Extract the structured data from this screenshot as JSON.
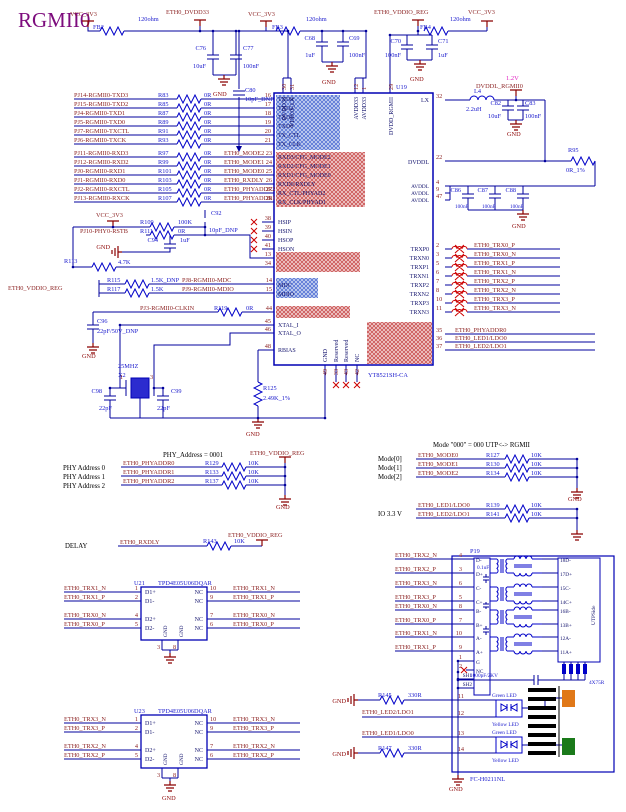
{
  "title": "RGMII0",
  "colors": {
    "wire": "#00009c",
    "part": "#1a1acd",
    "net": "#8a1f1f",
    "power": "#8b0000",
    "pink": "#e020c0",
    "purple": "#7d0c7d",
    "hatch_red": "#c03030",
    "hatch_blue": "#3355cc",
    "led_orange": "#e07818",
    "led_green": "#1a7a1a"
  },
  "top": {
    "vcc": "VCC_3V3",
    "fb2": "FB2",
    "fb3": "FB3",
    "fb4": "FB4",
    "ohm": "120ohm",
    "dvdd33": "ETH0_DVDD33",
    "vddio": "ETH0_VDDIO_REG",
    "gnd": "GND",
    "c76": "C76",
    "c76v": "10uF",
    "c77": "C77",
    "c77v": "100nF",
    "c80": "C80",
    "c80v": "10pF_DNP",
    "c68": "C68",
    "c68v": "1uF",
    "c69": "C69",
    "c69v": "100nF",
    "c70": "C70",
    "c70v": "100nF",
    "c71": "C71",
    "c71v": "1uF"
  },
  "chip": {
    "ref": "U19",
    "part": "YT8521SH-CA",
    "top_pins": [
      {
        "n": "30",
        "l": "DVDD33"
      },
      {
        "n": "31",
        "l": "VDD33_LX"
      },
      {
        "n": "12",
        "l": "AVDD33"
      },
      {
        "n": "1",
        "l": "AVDD33"
      },
      {
        "n": "29",
        "l": "DVDD_RGMII"
      }
    ],
    "lx": "LX",
    "n32": "32",
    "dvddl": "DVDDL",
    "n22": "22",
    "avddl": "AVDDL",
    "n4": "4",
    "n9": "9",
    "n47": "47",
    "gnd": "GND",
    "n49": "49",
    "res": "Reserved",
    "n33": "33",
    "n43": "43",
    "nc": "NC",
    "n42": "42"
  },
  "tx": [
    {
      "net": "PJ14-RGMII0-TXD3",
      "r": "R83",
      "v": "0R",
      "pin": "16",
      "l": "TXD3"
    },
    {
      "net": "PJ15-RGMII0-TXD2",
      "r": "R85",
      "v": "0R",
      "pin": "17",
      "l": "TXD2"
    },
    {
      "net": "PJ4-RGMII0-TXD1",
      "r": "R87",
      "v": "0R",
      "pin": "18",
      "l": "TXD1"
    },
    {
      "net": "PJ5-RGMII0-TXD0",
      "r": "R89",
      "v": "0R",
      "pin": "19",
      "l": "TXD0"
    },
    {
      "net": "PJ7-RGMII0-TXCTL",
      "r": "R91",
      "v": "0R",
      "pin": "20",
      "l": "TX_CTL"
    },
    {
      "net": "PJ6-RGMII0-TXCK",
      "r": "R93",
      "v": "0R",
      "pin": "21",
      "l": "TX_CLK"
    }
  ],
  "rx": [
    {
      "net": "PJ11-RGMII0-RXD3",
      "r": "R97",
      "v": "0R",
      "net2": "ETH0_MODE2",
      "pin": "23",
      "l": "RXD3/CFG_MODE2"
    },
    {
      "net": "PJ12-RGMII0-RXD2",
      "r": "R99",
      "v": "0R",
      "net2": "ETH0_MODE1",
      "pin": "24",
      "l": "RXD2/CFG_MODE1"
    },
    {
      "net": "PJ0-RGMII0-RXD1",
      "r": "R101",
      "v": "0R",
      "net2": "ETH0_MODE0",
      "pin": "25",
      "l": "RXD1/CFG_MODE0"
    },
    {
      "net": "PJ1-RGMII0-RXD0",
      "r": "R103",
      "v": "0R",
      "net2": "ETH0_RXDLY",
      "pin": "26",
      "l": "RXD0/RXDLY"
    },
    {
      "net": "PJ2-RGMII0-RXCTL",
      "r": "R105",
      "v": "0R",
      "net2": "ETH0_PHYADDR2",
      "pin": "27",
      "l": "RX_CTL/PHYAD2"
    },
    {
      "net": "PJ13-RGMII0-RXCK",
      "r": "R107",
      "v": "0R",
      "net2": "ETH0_PHYADDR1",
      "pin": "28",
      "l": "RX_CLK/PHYAD1"
    }
  ],
  "hs": [
    {
      "pin": "38",
      "l": "HSIP"
    },
    {
      "pin": "39",
      "l": "HSIN"
    },
    {
      "pin": "40",
      "l": "HSOP"
    },
    {
      "pin": "41",
      "l": "HSON"
    }
  ],
  "rst": {
    "vcc": "VCC_3V3",
    "r109": "R109",
    "r109v": "100K",
    "c92": "C92",
    "c92v": "10pF_DNP",
    "net": "PJ10-PHY0-RSTB",
    "r111": "R111",
    "r111v": "0R",
    "c94": "C94",
    "c94v": "1uF",
    "gnd": "GND",
    "r113": "R113",
    "r113v": "4.7K",
    "n13": "13",
    "n34": "34"
  },
  "mdio": {
    "vddio": "ETH0_VDDIO_REG",
    "r115": "R115",
    "r115v": "1.5K_DNP",
    "net_mdc": "PJ8-RGMII0-MDC",
    "n14": "14",
    "l_mdc": "MDC",
    "r117": "R117",
    "r117v": "1.5K",
    "net_mdio": "PJ9-RGMII0-MDIO",
    "n15": "15",
    "l_mdio": "MDIO"
  },
  "clk": {
    "net": "PJ3-RGMII0-CLKIN",
    "r": "R119",
    "v": "0R",
    "n44": "44"
  },
  "xtal": {
    "c96": "C96",
    "c96v": "22pF/50V_DNP",
    "gnd": "GND",
    "freq": "25MHZ",
    "x2": "X2",
    "p1": "1",
    "p3": "3",
    "c98": "C98",
    "c99": "C99",
    "v22": "22pF",
    "r125": "R125",
    "r125v": "2.49K_1%",
    "l45": "XTAL_I",
    "n45": "45",
    "l46": "XTAL_O",
    "n46": "46",
    "l48": "RBIAS",
    "n48": "48"
  },
  "pwr12": {
    "v12": "1.2V",
    "net": "DVDDL_RGMII0",
    "l4": "L4",
    "l4v": "2.2uH",
    "c82": "C82",
    "c82v": "10uF",
    "c83": "C83",
    "c83v": "100nF",
    "gnd": "GND",
    "r95": "R95",
    "r95v": "0R_1%",
    "c86": "C86",
    "c87": "C87",
    "c88": "C88",
    "c100": "100nF"
  },
  "trx": [
    {
      "pin": "2",
      "l": "TRXP0",
      "net": "ETH0_TRX0_P"
    },
    {
      "pin": "3",
      "l": "TRXN0",
      "net": "ETH0_TRX0_N"
    },
    {
      "pin": "5",
      "l": "TRXP1",
      "net": "ETH0_TRX1_P"
    },
    {
      "pin": "6",
      "l": "TRXN1",
      "net": "ETH0_TRX1_N"
    },
    {
      "pin": "7",
      "l": "TRXP2",
      "net": "ETH0_TRX2_P"
    },
    {
      "pin": "8",
      "l": "TRXN2",
      "net": "ETH0_TRX2_N"
    },
    {
      "pin": "10",
      "l": "TRXP3",
      "net": "ETH0_TRX3_P"
    },
    {
      "pin": "11",
      "l": "TRXN3",
      "net": "ETH0_TRX3_N"
    }
  ],
  "aux": [
    {
      "pin": "35",
      "net": "ETH0_PHYADDR0"
    },
    {
      "pin": "36",
      "net": "ETH0_LED1/LDO0"
    },
    {
      "pin": "37",
      "net": "ETH0_LED2/LDO1"
    }
  ],
  "phya": {
    "title": "PHY_Address = 0001",
    "vddio": "ETH0_VDDIO_REG",
    "gnd": "GND",
    "rows": [
      {
        "l": "PHY Address 0",
        "net": "ETH0_PHYADDR0",
        "r": "R129",
        "v": "10K"
      },
      {
        "l": "PHY Address 1",
        "net": "ETH0_PHYADDR1",
        "r": "R133",
        "v": "10K"
      },
      {
        "l": "PHY Address 2",
        "net": "ETH0_PHYADDR2",
        "r": "R137",
        "v": "10K"
      }
    ]
  },
  "mode": {
    "title": "Mode \"000\" = 000 UTP<-> RGMII",
    "gnd": "GND",
    "io": "IO 3.3 V",
    "rows": [
      {
        "l": "Mode[0]",
        "net": "ETH0_MODE0",
        "r": "R127",
        "v": "10K"
      },
      {
        "l": "Mode[1]",
        "net": "ETH0_MODE1",
        "r": "R130",
        "v": "10K"
      },
      {
        "l": "Mode[2]",
        "net": "ETH0_MODE2",
        "r": "R134",
        "v": "10K"
      }
    ],
    "leds": [
      {
        "net": "ETH0_LED1/LDO0",
        "r": "R139",
        "v": "10K"
      },
      {
        "net": "ETH0_LED2/LDO1",
        "r": "R141",
        "v": "10K"
      }
    ]
  },
  "delay": {
    "l": "DELAY",
    "net": "ETH0_RXDLY",
    "r": "R143",
    "v": "10K",
    "vddio": "ETH0_VDDIO_REG"
  },
  "u21": {
    "ref": "U21",
    "part": "TPD4E05U06DQAR",
    "p3": "3",
    "p8": "8",
    "lgnd": "GND",
    "left": [
      {
        "net": "ETH0_TRX1_N",
        "pin": "1",
        "l": "D1+"
      },
      {
        "net": "ETH0_TRX1_P",
        "pin": "2",
        "l": "D1-"
      },
      {
        "net": "ETH0_TRX0_N",
        "pin": "4",
        "l": "D2+"
      },
      {
        "net": "ETH0_TRX0_P",
        "pin": "5",
        "l": "D2-"
      }
    ],
    "right": [
      {
        "pin": "10",
        "nc": "NC",
        "net": "ETH0_TRX1_N"
      },
      {
        "pin": "9",
        "nc": "NC",
        "net": "ETH0_TRX1_P"
      },
      {
        "pin": "7",
        "nc": "NC",
        "net": "ETH0_TRX0_N"
      },
      {
        "pin": "6",
        "nc": "NC",
        "net": "ETH0_TRX0_P"
      }
    ]
  },
  "u23": {
    "ref": "U23",
    "part": "TPD4E05U06DQAR",
    "p3": "3",
    "p8": "8",
    "lgnd": "GND",
    "gnd": "GND",
    "left": [
      {
        "net": "ETH0_TRX3_N",
        "pin": "1",
        "l": "D1+"
      },
      {
        "net": "ETH0_TRX3_P",
        "pin": "2",
        "l": "D1-"
      },
      {
        "net": "ETH0_TRX2_N",
        "pin": "4",
        "l": "D2+"
      },
      {
        "net": "ETH0_TRX2_P",
        "pin": "5",
        "l": "D2-"
      }
    ],
    "right": [
      {
        "pin": "10",
        "nc": "NC",
        "net": "ETH0_TRX3_N"
      },
      {
        "pin": "9",
        "nc": "NC",
        "net": "ETH0_TRX3_P"
      },
      {
        "pin": "7",
        "nc": "NC",
        "net": "ETH0_TRX2_N"
      },
      {
        "pin": "6",
        "nc": "NC",
        "net": "ETH0_TRX2_P"
      }
    ]
  },
  "p19": {
    "ref": "P19",
    "part": "FC-H0211NL",
    "gnd": "GND",
    "capct": "0.1uF",
    "caphv": "1000pF/2KV",
    "rpack": "4X75R",
    "side": "UTPSide",
    "sh1": "SH1",
    "sh2": "SH2",
    "g": {
      "pin": "1",
      "l": "G"
    },
    "nc": {
      "pin": "2",
      "l": "NC"
    },
    "rows": [
      {
        "net": "ETH0_TRX2_N",
        "pin": "4",
        "l": "D-",
        "rj": "18D-"
      },
      {
        "net": "ETH0_TRX2_P",
        "pin": "3",
        "l": "D+",
        "rj": "17D+"
      },
      {
        "net": "ETH0_TRX3_N",
        "pin": "6",
        "l": "C-",
        "rj": "15C-"
      },
      {
        "net": "ETH0_TRX3_P",
        "pin": "5",
        "l": "C+",
        "rj": "14C+"
      },
      {
        "net": "ETH0_TRX0_N",
        "pin": "8",
        "l": "B-",
        "rj": "16B-"
      },
      {
        "net": "ETH0_TRX0_P",
        "pin": "7",
        "l": "B+",
        "rj": "13B+"
      },
      {
        "net": "ETH0_TRX1_N",
        "pin": "10",
        "l": "A-",
        "rj": "12A-"
      },
      {
        "net": "ETH0_TRX1_P",
        "pin": "9",
        "l": "A+",
        "rj": "11A+"
      }
    ],
    "leds": [
      {
        "gnd": "GND",
        "r": "R145",
        "v": "330R",
        "pin": "11",
        "led": "Green LED"
      },
      {
        "net": "ETH0_LED2/LDO1",
        "pin": "12",
        "led": "Yellow LED"
      },
      {
        "net": "ETH0_LED1/LDO0",
        "pin": "13",
        "led": "Green LED"
      },
      {
        "gnd": "GND",
        "r": "R147",
        "v": "330R",
        "pin": "14",
        "led": "Yellow LED"
      }
    ]
  }
}
